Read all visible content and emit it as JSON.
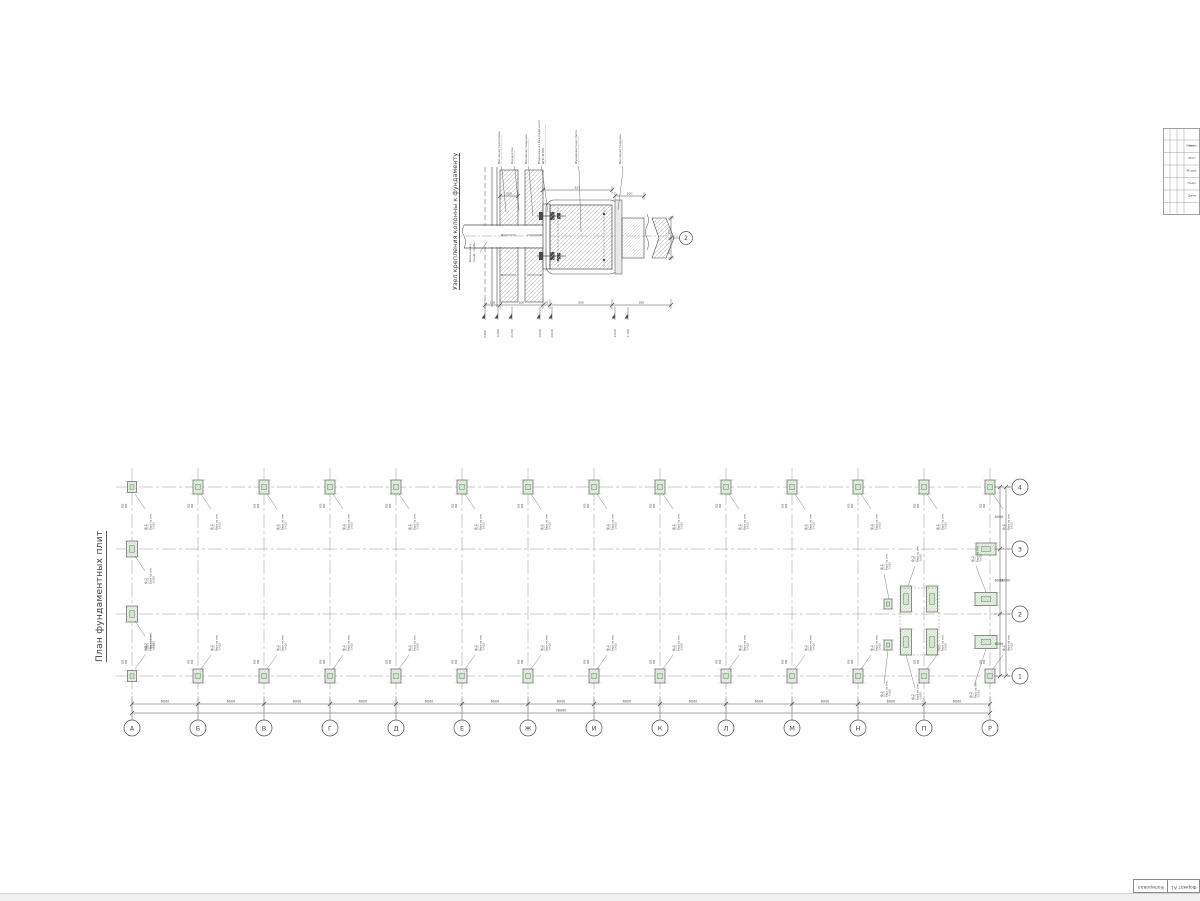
{
  "sheet": {
    "ink": "#4a4a4a",
    "ink_light": "#8f8f8f",
    "hatch": "#b9b9b9",
    "pad_fill": "#e7f2e5",
    "pad_core": "#cfe7cd",
    "pad_hatch": "#a3c7a0",
    "edge": "#d4d4d4"
  },
  "detail": {
    "title": "Узел крепления колонны к фундаменту",
    "axis_mark": "2",
    "column_label_lines": [
      "Колонна из",
      "проф. трубы"
    ],
    "callouts": [
      "Песчаная прослойка",
      "Кондуктор",
      "Песчаная подушка",
      "Подливка из безусадочного ЦПС М300",
      "Фундаментная плита",
      "Песчаная подушка"
    ],
    "top_dims": [
      "100",
      "625",
      "100"
    ],
    "bottom_dims": [
      "100",
      "600",
      "50",
      "600",
      "600"
    ],
    "side_dims": [
      "150",
      "150"
    ],
    "levels": [
      "0.000",
      "-0.100",
      "-0.150",
      "-0.620",
      "-0.640",
      "-1.020",
      "-1.100"
    ]
  },
  "plan": {
    "title": "План фундаментных плит",
    "col_axes": [
      "А",
      "Б",
      "В",
      "Г",
      "Д",
      "Е",
      "Ж",
      "И",
      "К",
      "Л",
      "М",
      "Н",
      "П",
      "Р"
    ],
    "row_axes": [
      "4",
      "3",
      "2",
      "1"
    ],
    "col_spacing": "6000",
    "col_total": "78000",
    "row_spacing": [
      "6000",
      "6000",
      "6000"
    ],
    "row_total": "18000",
    "pad_dim": "950",
    "pad_marks": {
      "f1": {
        "mark": "Ф-1",
        "note": "Верх на отм.",
        "level": "-0.620"
      },
      "f2": {
        "mark": "Ф-2",
        "note": "Верх на отм.",
        "level": "-0.620"
      }
    }
  },
  "title_strip": {
    "rows": [
      "Изм.",
      "Кол.уч.",
      "Лист",
      "№ док.",
      "Подп.",
      "Дата"
    ]
  },
  "corner": {
    "left": "Копировал",
    "right": "Формат А1"
  }
}
